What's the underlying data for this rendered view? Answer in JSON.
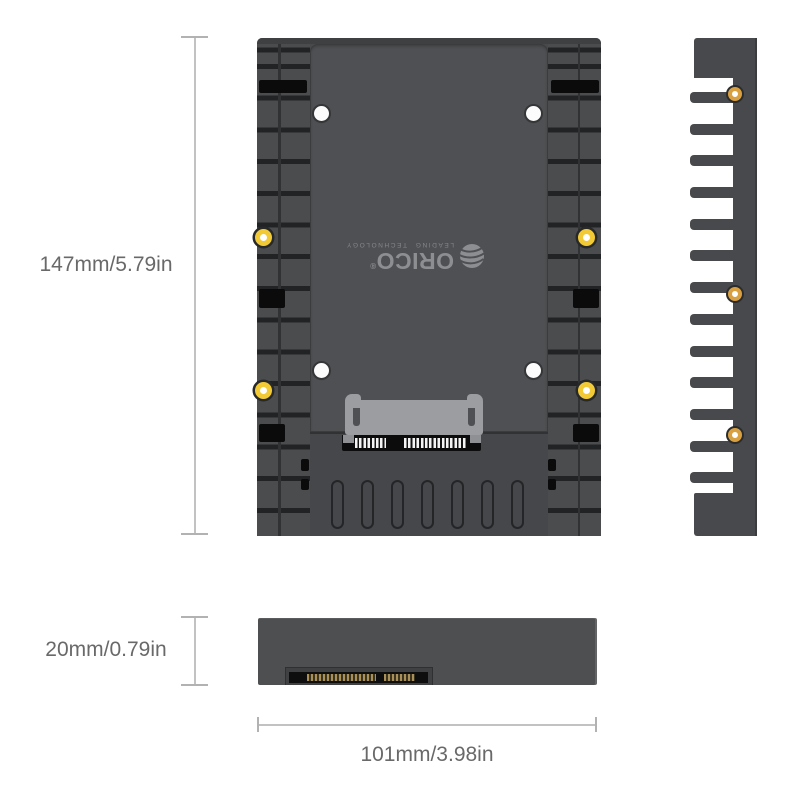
{
  "page": {
    "background": "#ffffff",
    "description": "ORICO 2.5 to 3.5 inch hard drive adapter caddy dimension diagram"
  },
  "product": {
    "brand": "ORICO",
    "registered_mark": "®",
    "tagline": "LEADING TECHNOLOGY"
  },
  "dimensions": {
    "height": {
      "label": "147mm/5.79in",
      "mm": 147,
      "inches": 5.79
    },
    "thickness": {
      "label": "20mm/0.79in",
      "mm": 20,
      "inches": 0.79
    },
    "width": {
      "label": "101mm/3.98in",
      "mm": 101,
      "inches": 3.98
    }
  },
  "views": {
    "front": "front-view",
    "side": "side-view",
    "bottom": "bottom-view"
  },
  "colors": {
    "body_gray": "#47494b",
    "tray_gray": "#4e5053",
    "groove_dark": "#212325",
    "slot_black": "#0b0b0c",
    "connector_gray": "#9c9da0",
    "pin_white": "#f4f4f4",
    "eyelet_gold_front": "#f2ca35",
    "eyelet_gold_side": "#d9a041",
    "mount_hole_white": "#fcfcfc",
    "logo_gray": "#8c8e91",
    "dimension_line": "#c2c2c2",
    "dimension_text": "#696969"
  }
}
